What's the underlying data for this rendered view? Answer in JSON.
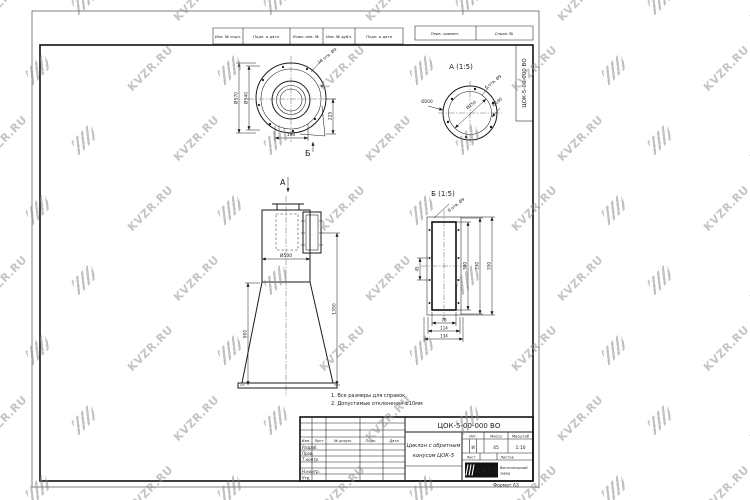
{
  "watermark": {
    "text": "KVZR.RU"
  },
  "frame": {
    "margin_cells": [
      "Инв. № подл.",
      "Подп. и дата",
      "Взам. инв. №",
      "Инв. № дубл.",
      "Подп. и дата"
    ],
    "top_cells": [
      "Перв. примен.",
      "Справ. №"
    ],
    "vertical_designation": "ЦОК-5-00-000 ВО",
    "format_note": "Формат  А3"
  },
  "stamp": {
    "designation": "ЦОК-5-00-000 ВО",
    "title_line1": "Циклон с обратным",
    "title_line2": "конусом ЦОК-5",
    "header_cols": [
      "Изм.",
      "Лист",
      "№ докум.",
      "Подп.",
      "Дата"
    ],
    "rows": [
      "Разраб.",
      "Пров.",
      "Т.контр.",
      "Н.контр.",
      "Утв."
    ],
    "lit_header": "Лит.",
    "mass_header": "Масса",
    "scale_header": "Масштаб",
    "lit_value": "И",
    "mass_value": "45",
    "scale_value": "1:10",
    "sheet_header": "Лист",
    "sheets_header": "Листов",
    "company_logo": "KVZR",
    "company_line1": "Вентиляторный",
    "company_line2": "завод"
  },
  "views": {
    "top": {
      "ref_label": "Б",
      "holes": "18 отв. Ø9",
      "dia_outer": "Ø570",
      "dia_bolt": "Ø540",
      "dim_right": "225",
      "dim_bottom": "190"
    },
    "detail_a": {
      "title": "А (1:5)",
      "holes": "6 отв. Ø9",
      "dia_flange": "Ø200",
      "dia_bolt": "Ø180",
      "dia_inner": "Ø150"
    },
    "front": {
      "ref_label": "А",
      "dia": "Ø500",
      "height_cone": "900",
      "height_total": "1350"
    },
    "detail_b": {
      "title": "Б (1:5)",
      "holes": "8 отв. Ø9",
      "h_inner": "300",
      "h_mid": "330",
      "h_outer": "350",
      "w_inner": "78",
      "w_mid": "114",
      "w_outer": "134",
      "pitch": "45"
    }
  },
  "notes": [
    "1.  Все размеры для справок.",
    "2.  Допустимые отклонения  ±10мм"
  ]
}
